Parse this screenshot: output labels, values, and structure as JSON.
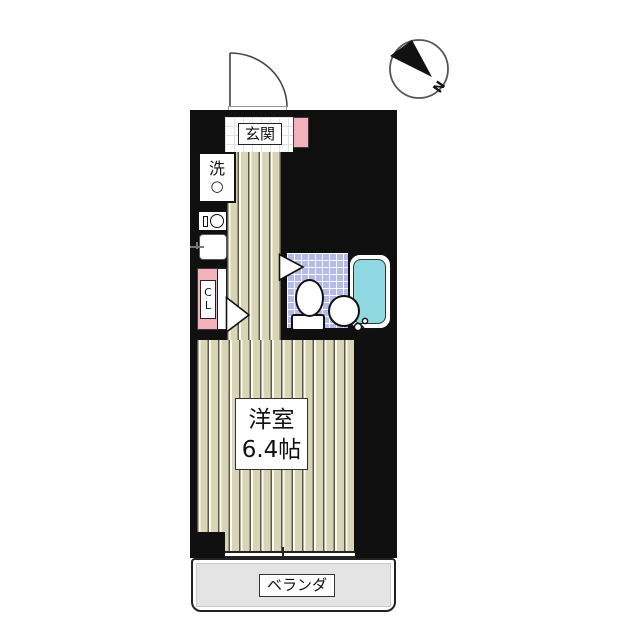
{
  "plan": {
    "compass": {
      "label": "N"
    },
    "entrance": {
      "label": "玄関"
    },
    "laundry": {
      "label": "洗",
      "symbol": "○"
    },
    "closet": {
      "line1": "C",
      "line2": "L"
    },
    "room": {
      "name": "洋室",
      "size": "6.4帖"
    },
    "veranda": {
      "label": "ベランダ"
    }
  },
  "colors": {
    "wall": "#101010",
    "flooring": "#d9d5b4",
    "flooring_line": "#5b594e",
    "accent_pink": "#f3b1bc",
    "bath_tile": "#b6bae7",
    "bathtub_water": "#8fd8e2",
    "veranda_gray": "#e4e4e4"
  }
}
